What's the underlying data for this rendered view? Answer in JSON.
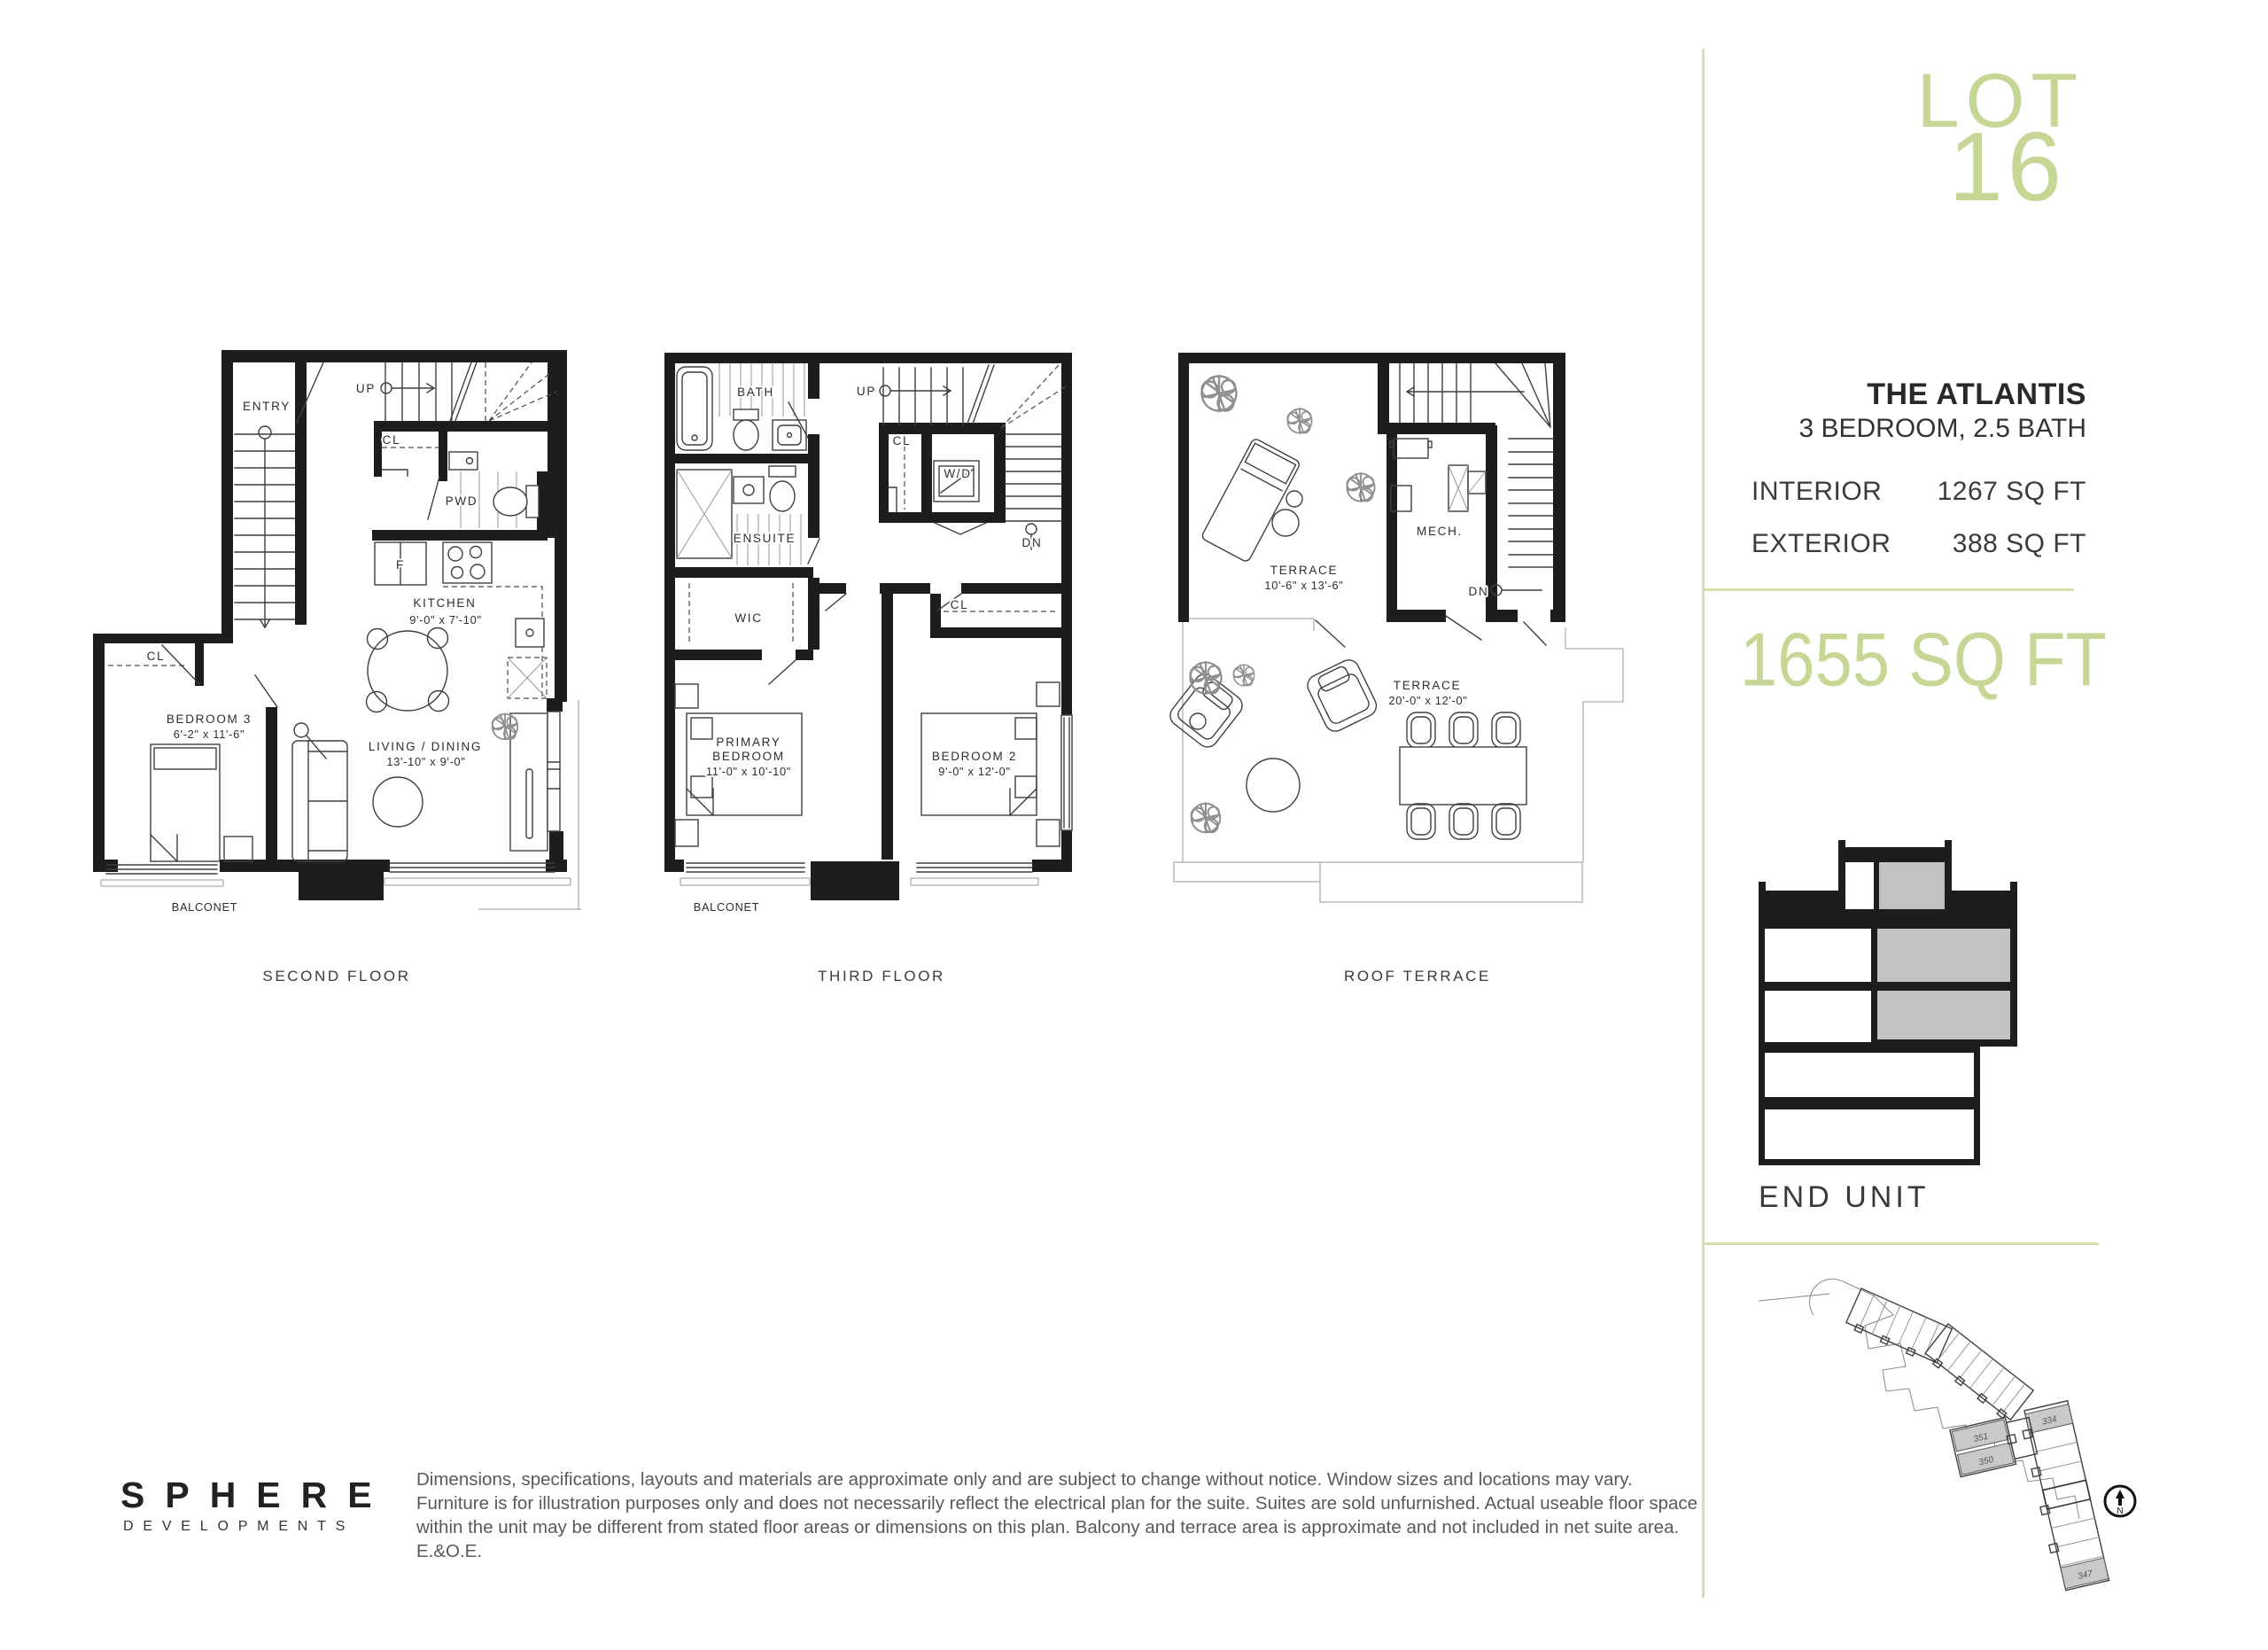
{
  "colors": {
    "accent_green": "#c6d795",
    "divider_green": "#d9e0ad",
    "section_highlight_gray": "#c1c2c4",
    "wall_black": "#1d1d1b"
  },
  "sidebar": {
    "logo_line1": "LOT",
    "logo_line2": "16",
    "unit_name": "THE ATLANTIS",
    "unit_spec": "3 BEDROOM, 2.5 BATH",
    "stats": [
      {
        "label": "INTERIOR",
        "value": "1267 SQ FT"
      },
      {
        "label": "EXTERIOR",
        "value": "388 SQ FT"
      }
    ],
    "total_area": "1655 SQ FT",
    "unit_position": "END UNIT",
    "site": {
      "units": [
        "334",
        "351",
        "350",
        "347"
      ],
      "compass": "N"
    }
  },
  "plans": [
    {
      "id": "second-floor",
      "title": "SECOND FLOOR",
      "labels": {
        "entry": "ENTRY",
        "up": "UP",
        "cl_a": "CL",
        "pwd": "PWD",
        "kitchen": "KITCHEN",
        "kitchen_dim": "9'-0\" x 7'-10\"",
        "fridge": "F",
        "bedroom3": "BEDROOM 3",
        "bedroom3_dim": "6'-2\" x 11'-6\"",
        "cl_b": "CL",
        "living": "LIVING / DINING",
        "living_dim": "13'-10\" x 9'-0\"",
        "balconet": "BALCONET"
      }
    },
    {
      "id": "third-floor",
      "title": "THIRD FLOOR",
      "labels": {
        "bath": "BATH",
        "up": "UP",
        "cl_a": "CL",
        "wd": "W/D",
        "dn": "DN",
        "ensuite": "ENSUITE",
        "wic": "WIC",
        "cl_b": "CL",
        "primary_1": "PRIMARY",
        "primary_2": "BEDROOM",
        "primary_dim": "11'-0\" x 10'-10\"",
        "bedroom2": "BEDROOM 2",
        "bedroom2_dim": "9'-0\" x 12'-0\"",
        "balconet": "BALCONET"
      }
    },
    {
      "id": "roof-terrace",
      "title": "ROOF TERRACE",
      "labels": {
        "terrace_a": "TERRACE",
        "terrace_a_dim": "10'-6\" x 13'-6\"",
        "mech": "MECH.",
        "dn": "DN",
        "terrace_b": "TERRACE",
        "terrace_b_dim": "20'-0\" x 12'-0\""
      }
    }
  ],
  "footer": {
    "brand": "SPHERE",
    "brand_sub": "DEVELOPMENTS",
    "disclaimer": "Dimensions, specifications, layouts and materials are approximate only and are subject to change without notice. Window sizes and locations may vary. Furniture is for illustration purposes only and does not necessarily reflect the electrical plan for the suite. Suites are sold unfurnished. Actual useable floor space within the unit may be different from stated floor areas or dimensions on this plan. Balcony and terrace area is approximate and not included in net suite area. E.&O.E."
  }
}
